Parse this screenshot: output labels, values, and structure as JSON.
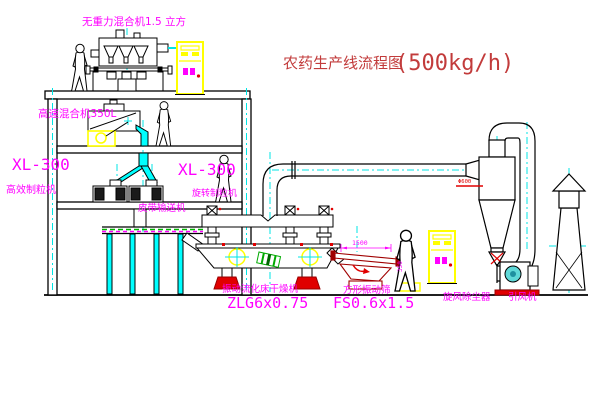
{
  "diagram": {
    "title": {
      "prefix": "农药生产线流程图",
      "capacity": "(500kg/h)"
    },
    "labels": {
      "gravity_mixer": "无重力混合机1.5 立方",
      "high_speed_mixer": "高速混合机350L",
      "granulator_left_model": "XL-300",
      "granulator_left_name": "高效制粒机",
      "granulator_mid_model": "XL-300",
      "granulator_mid_name": "旋转制粒机",
      "belt_conveyor": "皮带输送机",
      "dryer_name": "振动流化床干燥机",
      "dryer_model": "ZLG6x0.75",
      "screen_name": "方形振动筛",
      "screen_model": "FS0.6x1.5",
      "cyclone": "旋风除尘器",
      "fan": "引风机"
    },
    "dimensions": {
      "screen_length": "1500",
      "screen_height": "350",
      "cyclone_diameter": "Φ600"
    },
    "colors": {
      "label_magenta": "#FF00FF",
      "title_red": "#C23B3B",
      "accent_red": "#E00000",
      "centerline_cyan": "#00E5E5",
      "equipment_yellow": "#FFFF00",
      "screen_darkred": "#A00000",
      "conveyor_green": "#00B400",
      "line_black": "#000000"
    }
  }
}
